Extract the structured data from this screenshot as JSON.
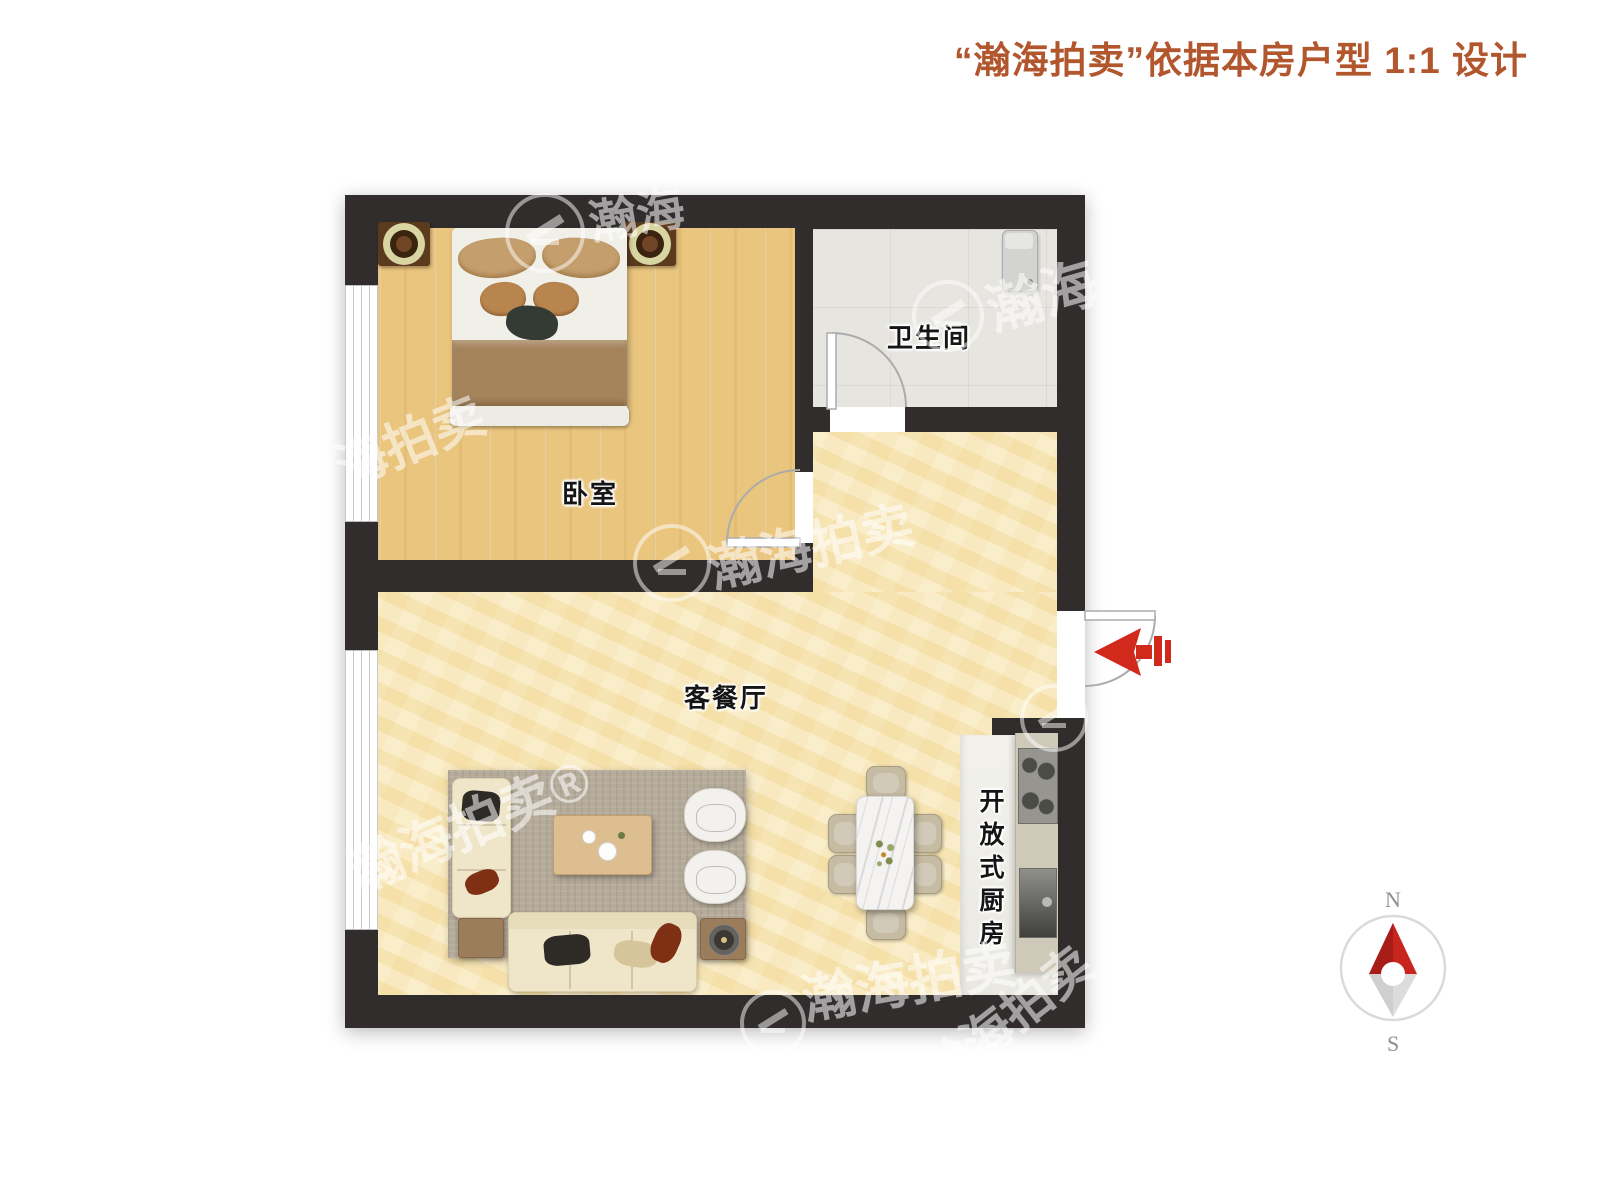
{
  "header": {
    "title": "“瀚海拍卖”依据本房户型 1:1 设计",
    "title_color": "#b1562d"
  },
  "rooms": {
    "bedroom": {
      "label": "卧室"
    },
    "bathroom": {
      "label": "卫生间"
    },
    "living": {
      "label": "客餐厅"
    },
    "kitchen": {
      "label": "开放式厨房"
    }
  },
  "compass": {
    "north": "N",
    "south": "S",
    "needle_color": "#c8251e",
    "ring_color": "#dadada"
  },
  "entry": {
    "arrow_color": "#d1291b"
  },
  "watermark": {
    "brand": "瀚海拍卖",
    "items": [
      {
        "text": "海拍卖"
      },
      {
        "text": "瀚海"
      },
      {
        "text": "瀚海拍卖"
      },
      {
        "text": "瀚海"
      },
      {
        "text": "瀚海拍卖®"
      },
      {
        "text": "瀚海拍卖"
      },
      {
        "text": "瀚海拍卖"
      }
    ]
  },
  "colors": {
    "wall": "#322d2d",
    "wood_floor": "#eac57e",
    "living_floor": "#f7e8be",
    "bath_floor": "#e7e5e0",
    "kitchen_floor": "#f0efea",
    "arrow_red": "#d1291b"
  }
}
